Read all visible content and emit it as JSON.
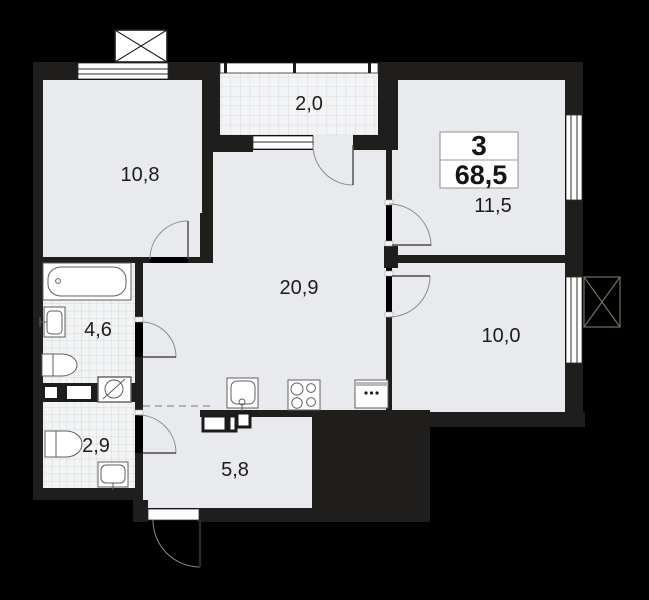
{
  "title": "apartment-floor-plan",
  "badge": {
    "rooms_count": "3",
    "total_area": "68,5"
  },
  "rooms": [
    {
      "name": "bedroom-top-left",
      "area": "10,8"
    },
    {
      "name": "balcony",
      "area": "2,0"
    },
    {
      "name": "bedroom-top-right",
      "area": "11,5"
    },
    {
      "name": "living-kitchen",
      "area": "20,9"
    },
    {
      "name": "bathroom",
      "area": "4,6"
    },
    {
      "name": "bedroom-right",
      "area": "10,0"
    },
    {
      "name": "wc",
      "area": "2,9"
    },
    {
      "name": "hallway",
      "area": "5,8"
    }
  ],
  "fixtures": [
    "bathtub",
    "washbasin",
    "toilet",
    "washing-machine",
    "kitchen-sink",
    "stove",
    "fridge"
  ],
  "colors": {
    "background": "#000000",
    "wall": "#201e1c",
    "floor": "#e8eaed",
    "tile": "#f3f4f5",
    "tile_grid": "#d6d9db",
    "label": "#1c1c1c",
    "badge_bg": "#ffffff",
    "badge_border": "#8f8f8f",
    "fixture_stroke": "#5f5f5f",
    "door": "#8b8b8b",
    "window_line": "#2e2e2e"
  }
}
